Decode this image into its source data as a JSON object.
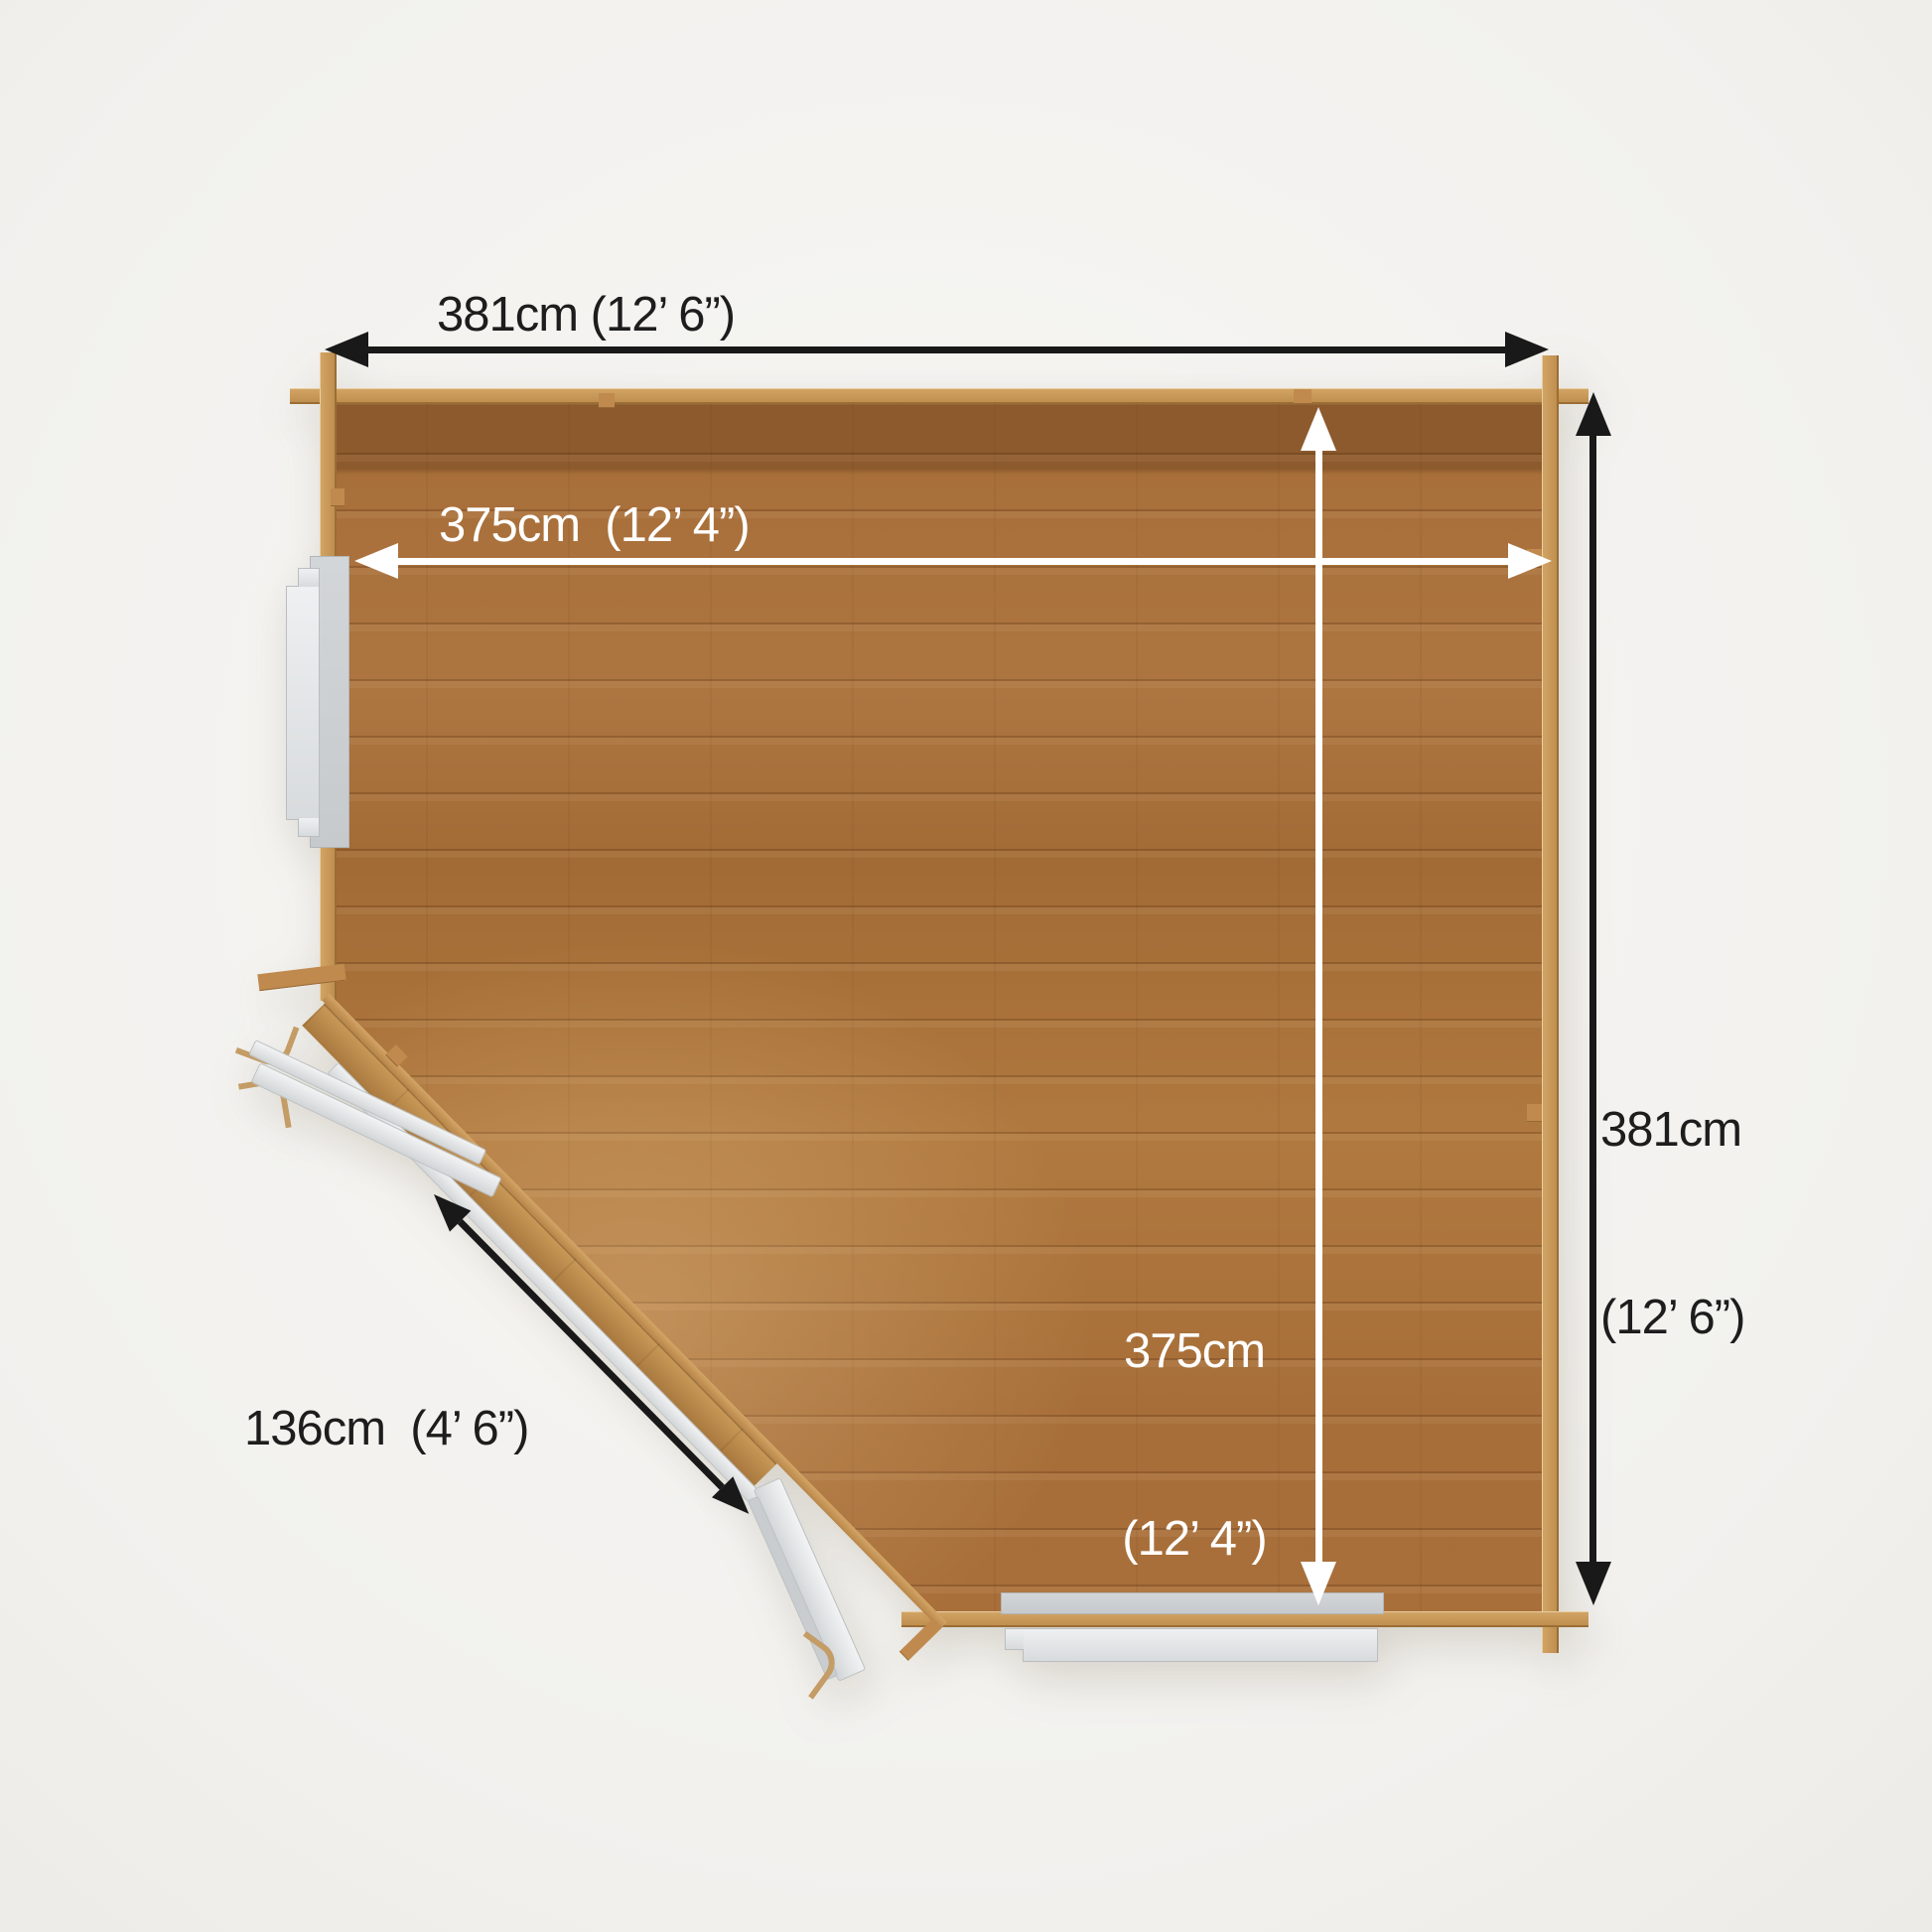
{
  "diagram": {
    "title": "corner-summerhouse-floor-plan",
    "dimensions": {
      "external_width": {
        "text": "381cm (12’ 6”)",
        "value_cm": 381,
        "imperial": "12’ 6”",
        "arrow_color": "#191919"
      },
      "internal_width": {
        "text": "375cm  (12’ 4”)",
        "value_cm": 375,
        "imperial": "12’ 4”",
        "arrow_color": "#ffffff"
      },
      "external_depth": {
        "line1": "381cm",
        "line2": "(12’ 6”)",
        "value_cm": 381,
        "imperial": "12’ 6”",
        "arrow_color": "#191919"
      },
      "internal_depth": {
        "line1": "375cm",
        "line2": "(12’ 4”)",
        "value_cm": 375,
        "imperial": "12’ 4”",
        "arrow_color": "#ffffff"
      },
      "corner_door_width": {
        "text": "136cm  (4’ 6”)",
        "value_cm": 136,
        "imperial": "4’ 6”",
        "arrow_color": "#191919"
      }
    },
    "colors": {
      "background": "#f5f4f1",
      "floor_wood": "#a86f3a",
      "floor_wood_dark_band": "#8c5a2d",
      "wall_wood": "#c6985c",
      "window_gray": "#d6d9db",
      "arrow_black": "#191919",
      "arrow_white": "#ffffff",
      "label_text": "#1d1d1d"
    }
  }
}
